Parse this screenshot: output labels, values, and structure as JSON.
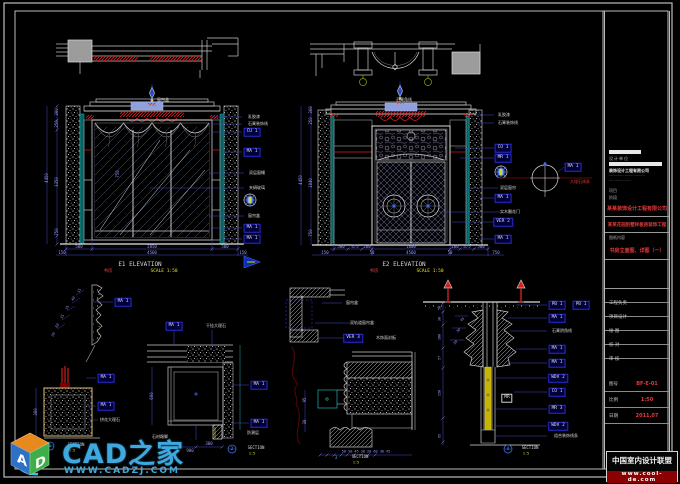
{
  "palette": {
    "w": "#d6d6d6",
    "d": "#9b9bff",
    "r": "#e23a3a",
    "y": "#e3e32a",
    "b": "#58a6ff",
    "g": "#9a9a9a"
  },
  "logo": {
    "brand": "CAD之家",
    "url": "WWW.CADZJ.COM",
    "cube_letters": [
      "A",
      "D"
    ]
  },
  "title_block": {
    "unit_caption": "设计单位",
    "unit_sub": "装饰设计工程有限公司",
    "info_lines": [
      "································",
      "····················"
    ],
    "stage_lines": [
      "项目",
      "阶段"
    ],
    "company": "某某装饰设计工程有限公司",
    "project": "某某花园别墅样板房装饰工程",
    "content_caption": "图纸内容",
    "drawing_title": "书房立面图、详图（一）",
    "rows": [
      "工程负责",
      "项目设计",
      "绘 图",
      "校 对",
      "审 核"
    ],
    "fields": [
      {
        "label": "图号",
        "value": "BF-E-01"
      },
      {
        "label": "比例",
        "value": "1:50"
      },
      {
        "label": "日期",
        "value": "2011.07"
      }
    ],
    "wm_title": "中国室内设计联盟",
    "wm_url": "www.cool-de.com"
  },
  "annotations": [
    {
      "t": "300",
      "x": 57,
      "y": 112,
      "r": -90,
      "s": 4
    },
    {
      "t": "250",
      "x": 57,
      "y": 124,
      "r": -90,
      "s": 4
    },
    {
      "t": "4450",
      "x": 47,
      "y": 178,
      "r": -90,
      "s": 4
    },
    {
      "t": "3350",
      "x": 57,
      "y": 182,
      "r": -90,
      "s": 4
    },
    {
      "t": "750",
      "x": 57,
      "y": 232,
      "r": -90,
      "s": 4
    },
    {
      "t": "750",
      "x": 118,
      "y": 174,
      "r": -90,
      "s": 4
    },
    {
      "t": "500",
      "x": 79,
      "y": 247,
      "s": 4
    },
    {
      "t": "2850",
      "x": 152,
      "y": 247,
      "s": 4
    },
    {
      "t": "500",
      "x": 225,
      "y": 247,
      "s": 4
    },
    {
      "t": "150",
      "x": 62,
      "y": 253,
      "s": 4
    },
    {
      "t": "4560",
      "x": 152,
      "y": 253,
      "s": 4
    },
    {
      "t": "150",
      "x": 243,
      "y": 253,
      "s": 4
    },
    {
      "t": "E1  ELEVATION",
      "x": 140,
      "y": 265,
      "c": "w",
      "s": 6
    },
    {
      "t": "书房",
      "x": 108,
      "y": 272,
      "c": "r",
      "s": 4.5
    },
    {
      "t": "SCALE 1:50",
      "x": 164,
      "y": 272,
      "c": "y",
      "s": 4.5
    },
    {
      "t": "窗帘盒",
      "x": 163,
      "y": 100,
      "c": "w",
      "s": 4
    },
    {
      "t": "乳胶漆",
      "x": 254,
      "y": 117,
      "c": "w",
      "s": 4
    },
    {
      "t": "石膏装饰线",
      "x": 258,
      "y": 124,
      "c": "w",
      "s": 4
    },
    {
      "t": "CU 1",
      "x": 252,
      "y": 132,
      "b": "blue"
    },
    {
      "t": "MA 1",
      "x": 252,
      "y": 152,
      "b": "blue"
    },
    {
      "t": "双层窗幔",
      "x": 257,
      "y": 173,
      "c": "w",
      "s": 4
    },
    {
      "t": "夹绢玻璃",
      "x": 257,
      "y": 188,
      "c": "w",
      "s": 4
    },
    {
      "t": "窗帘盒",
      "x": 254,
      "y": 216,
      "c": "w",
      "s": 4
    },
    {
      "t": "MA 1",
      "x": 252,
      "y": 228,
      "b": "blue"
    },
    {
      "t": "MA 1",
      "x": 252,
      "y": 239,
      "b": "blue"
    },
    {
      "t": "300",
      "x": 311,
      "y": 110,
      "r": -90,
      "s": 4
    },
    {
      "t": "250",
      "x": 311,
      "y": 121,
      "r": -90,
      "s": 4
    },
    {
      "t": "4450",
      "x": 301,
      "y": 180,
      "r": -90,
      "s": 4
    },
    {
      "t": "1840",
      "x": 311,
      "y": 183,
      "r": -90,
      "s": 4
    },
    {
      "t": "750",
      "x": 311,
      "y": 233,
      "r": -90,
      "s": 4
    },
    {
      "t": "500",
      "x": 341,
      "y": 247,
      "s": 4
    },
    {
      "t": "475",
      "x": 355,
      "y": 247,
      "s": 4
    },
    {
      "t": "160",
      "x": 367,
      "y": 247,
      "s": 4
    },
    {
      "t": "1600",
      "x": 411,
      "y": 247,
      "s": 4
    },
    {
      "t": "160",
      "x": 455,
      "y": 247,
      "s": 4
    },
    {
      "t": "475",
      "x": 467,
      "y": 247,
      "s": 4
    },
    {
      "t": "500",
      "x": 481,
      "y": 247,
      "s": 4
    },
    {
      "t": "150",
      "x": 325,
      "y": 253,
      "s": 4
    },
    {
      "t": "50",
      "x": 372,
      "y": 253,
      "s": 4
    },
    {
      "t": "4560",
      "x": 411,
      "y": 253,
      "s": 4
    },
    {
      "t": "50",
      "x": 450,
      "y": 253,
      "s": 4
    },
    {
      "t": "750",
      "x": 496,
      "y": 253,
      "s": 4
    },
    {
      "t": "E2  ELEVATION",
      "x": 404,
      "y": 265,
      "c": "w",
      "s": 6
    },
    {
      "t": "书房",
      "x": 374,
      "y": 272,
      "c": "r",
      "s": 4.5
    },
    {
      "t": "SCALE 1:50",
      "x": 430,
      "y": 272,
      "c": "y",
      "s": 4.5
    },
    {
      "t": "石膏角线",
      "x": 404,
      "y": 100,
      "c": "w",
      "s": 4
    },
    {
      "t": "乳胶漆",
      "x": 504,
      "y": 115,
      "c": "w",
      "s": 4
    },
    {
      "t": "石膏装饰线",
      "x": 508,
      "y": 123,
      "c": "w",
      "s": 4
    },
    {
      "t": "CO 1",
      "x": 503,
      "y": 148,
      "b": "blue"
    },
    {
      "t": "MR 1",
      "x": 503,
      "y": 158,
      "b": "blue"
    },
    {
      "t": "双层窗帘",
      "x": 508,
      "y": 188,
      "c": "w",
      "s": 4
    },
    {
      "t": "MA 1",
      "x": 503,
      "y": 198,
      "b": "blue"
    },
    {
      "t": "实木雕花门",
      "x": 510,
      "y": 212,
      "c": "w",
      "s": 4
    },
    {
      "t": "VER 2",
      "x": 503,
      "y": 222,
      "b": "blue"
    },
    {
      "t": "MA 1",
      "x": 503,
      "y": 239,
      "b": "blue"
    },
    {
      "t": "MA 1",
      "x": 573,
      "y": 167,
      "b": "blue"
    },
    {
      "t": "大理石线条",
      "x": 580,
      "y": 182,
      "c": "r",
      "s": 4
    },
    {
      "t": "MA 1",
      "x": 123,
      "y": 302,
      "b": "blue"
    },
    {
      "t": "15",
      "x": 80,
      "y": 291,
      "r": -60,
      "s": 3.5
    },
    {
      "t": "40",
      "x": 74,
      "y": 299,
      "r": -60,
      "s": 3.5
    },
    {
      "t": "25",
      "x": 68,
      "y": 308,
      "r": -60,
      "s": 3.5
    },
    {
      "t": "35",
      "x": 63,
      "y": 317,
      "r": -60,
      "s": 3.5
    },
    {
      "t": "60",
      "x": 58,
      "y": 326,
      "r": -60,
      "s": 3.5
    },
    {
      "t": "20",
      "x": 54,
      "y": 335,
      "r": -60,
      "s": 3.5
    },
    {
      "t": "MA 1",
      "x": 106,
      "y": 378,
      "b": "blue"
    },
    {
      "t": "MA 1",
      "x": 106,
      "y": 406,
      "b": "blue"
    },
    {
      "t": "拼花大理石",
      "x": 110,
      "y": 420,
      "c": "w",
      "s": 4
    },
    {
      "t": "300",
      "x": 36,
      "y": 412,
      "r": -90,
      "s": 4
    },
    {
      "t": "1",
      "x": 50,
      "y": 446,
      "c": "b",
      "s": 4
    },
    {
      "t": "SECTION",
      "x": 76,
      "y": 445,
      "c": "w",
      "s": 4
    },
    {
      "t": "1:5",
      "x": 72,
      "y": 451,
      "c": "y",
      "s": 3.5
    },
    {
      "t": "MA 1",
      "x": 174,
      "y": 326,
      "b": "blue"
    },
    {
      "t": "干挂大理石",
      "x": 216,
      "y": 326,
      "c": "w",
      "s": 4
    },
    {
      "t": "600",
      "x": 152,
      "y": 396,
      "r": -90,
      "s": 4
    },
    {
      "t": "MA 1",
      "x": 259,
      "y": 385,
      "b": "blue"
    },
    {
      "t": "MA 1",
      "x": 259,
      "y": 423,
      "b": "blue"
    },
    {
      "t": "石材踢脚",
      "x": 160,
      "y": 437,
      "c": "w",
      "s": 4
    },
    {
      "t": "防潮层",
      "x": 253,
      "y": 433,
      "c": "w",
      "s": 4
    },
    {
      "t": "300",
      "x": 209,
      "y": 444,
      "s": 4
    },
    {
      "t": "900",
      "x": 190,
      "y": 451,
      "s": 4
    },
    {
      "t": "2",
      "x": 232,
      "y": 449,
      "c": "b",
      "s": 4
    },
    {
      "t": "SECTION",
      "x": 256,
      "y": 448,
      "c": "w",
      "s": 4
    },
    {
      "t": "1:5",
      "x": 252,
      "y": 454,
      "c": "y",
      "s": 3.5
    },
    {
      "t": "窗帘盒",
      "x": 352,
      "y": 303,
      "c": "w",
      "s": 4
    },
    {
      "t": "双轨道窗帘盒",
      "x": 362,
      "y": 323,
      "c": "w",
      "s": 4
    },
    {
      "t": "VER 3",
      "x": 353,
      "y": 338,
      "b": "blue"
    },
    {
      "t": "木饰面封板",
      "x": 386,
      "y": 338,
      "c": "w",
      "s": 4
    },
    {
      "t": "95",
      "x": 305,
      "y": 400,
      "r": -90,
      "s": 4
    },
    {
      "t": "30",
      "x": 305,
      "y": 422,
      "r": -90,
      "s": 4
    },
    {
      "t": "50 50 45 30 20 60 30 45",
      "x": 366,
      "y": 452,
      "s": 3.5
    },
    {
      "t": "3",
      "x": 336,
      "y": 458,
      "c": "b",
      "s": 4
    },
    {
      "t": "SECTION",
      "x": 360,
      "y": 457,
      "c": "w",
      "s": 4
    },
    {
      "t": "1:5",
      "x": 356,
      "y": 463,
      "c": "y",
      "s": 3.5
    },
    {
      "t": "50",
      "x": 440,
      "y": 308,
      "r": -90,
      "s": 3.5
    },
    {
      "t": "30",
      "x": 440,
      "y": 319,
      "r": -90,
      "s": 3.5
    },
    {
      "t": "100",
      "x": 440,
      "y": 337,
      "r": -90,
      "s": 3.5
    },
    {
      "t": "57",
      "x": 440,
      "y": 358,
      "r": -90,
      "s": 3.5
    },
    {
      "t": "150",
      "x": 440,
      "y": 393,
      "r": -90,
      "s": 3.5
    },
    {
      "t": "95",
      "x": 440,
      "y": 436,
      "r": -90,
      "s": 3.5
    },
    {
      "t": "45",
      "x": 463,
      "y": 320,
      "r": -45,
      "s": 3.5
    },
    {
      "t": "30",
      "x": 459,
      "y": 331,
      "r": -45,
      "s": 3.5
    },
    {
      "t": "20",
      "x": 456,
      "y": 343,
      "r": -45,
      "s": 3.5
    },
    {
      "t": "PB 1",
      "x": 557,
      "y": 305,
      "b": "blue"
    },
    {
      "t": "PB 1",
      "x": 581,
      "y": 305,
      "b": "blue"
    },
    {
      "t": "MA 1",
      "x": 557,
      "y": 318,
      "b": "blue"
    },
    {
      "t": "石膏阴角线",
      "x": 562,
      "y": 331,
      "c": "w",
      "s": 4
    },
    {
      "t": "MA 1",
      "x": 557,
      "y": 349,
      "b": "blue"
    },
    {
      "t": "MA 1",
      "x": 557,
      "y": 363,
      "b": "blue"
    },
    {
      "t": "WDV 2",
      "x": 558,
      "y": 378,
      "b": "blue"
    },
    {
      "t": "CO 1",
      "x": 557,
      "y": 392,
      "b": "blue"
    },
    {
      "t": "MR 3",
      "x": 557,
      "y": 409,
      "b": "blue"
    },
    {
      "t": "WDV 2",
      "x": 558,
      "y": 426,
      "b": "blue"
    },
    {
      "t": "组合装饰线条",
      "x": 566,
      "y": 436,
      "c": "w",
      "s": 4
    },
    {
      "t": "MR",
      "x": 507,
      "y": 398,
      "b": "white"
    },
    {
      "t": "4",
      "x": 508,
      "y": 449,
      "c": "b",
      "s": 4
    },
    {
      "t": "SECTION",
      "x": 530,
      "y": 448,
      "c": "w",
      "s": 4
    },
    {
      "t": "1:5",
      "x": 526,
      "y": 454,
      "c": "y",
      "s": 3.5
    }
  ]
}
